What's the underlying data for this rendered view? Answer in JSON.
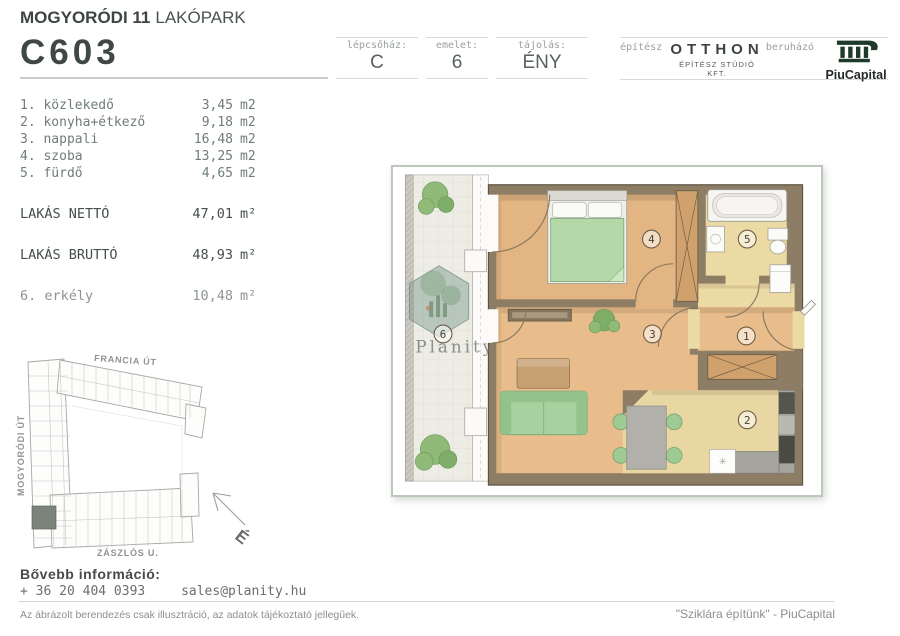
{
  "header": {
    "title_bold": "MOGYORÓDI 11",
    "title_light": "LAKÓPARK",
    "unit_code": "C603",
    "cells": [
      {
        "label": "lépcsőház:",
        "value": "C"
      },
      {
        "label": "emelet:",
        "value": "6"
      },
      {
        "label": "tájolás:",
        "value": "ÉNY"
      }
    ],
    "architect": {
      "label": "építész",
      "name": "OTTHON",
      "subtitle": "ÉPÍTÉSZ STÚDIÓ KFT."
    },
    "developer": {
      "label": "beruházó",
      "name": "PiuCapital"
    }
  },
  "room_list": {
    "rooms": [
      {
        "name": "1. közlekedő",
        "area": "3,45",
        "unit": "m2"
      },
      {
        "name": "2. konyha+étkező",
        "area": "9,18",
        "unit": "m2"
      },
      {
        "name": "3. nappali",
        "area": "16,48",
        "unit": "m2"
      },
      {
        "name": "4. szoba",
        "area": "13,25",
        "unit": "m2"
      },
      {
        "name": "5. fürdő",
        "area": "4,65",
        "unit": "m2"
      }
    ],
    "totals": [
      {
        "name": "LAKÁS NETTÓ",
        "area": "47,01",
        "unit": "m²"
      },
      {
        "name": "LAKÁS BRUTTÓ",
        "area": "48,93",
        "unit": "m²"
      }
    ],
    "balcony": {
      "name": "6. erkély",
      "area": "10,48",
      "unit": "m²"
    }
  },
  "site_plan": {
    "street_top": "FRANCIA ÚT",
    "street_left": "MOGYORÓDI ÚT",
    "street_bottom": "ZÁSZLÓS U.",
    "north": "É"
  },
  "floor_plan": {
    "watermark": "Planity",
    "numbers": {
      "hall": "1",
      "kitchen": "2",
      "living": "3",
      "bedroom": "4",
      "bath": "5",
      "balcony": "6"
    }
  },
  "footer": {
    "info_title": "Bővebb információ:",
    "phone": "+ 36 20 404 0393",
    "email": "sales@planity.hu",
    "disclaimer": "Az ábrázolt berendezés csak illusztráció, az adatok tájékoztató jellegűek.",
    "slogan": "\"Sziklára építünk\" - PiuCapital"
  },
  "colors": {
    "brand_green": "#1d3a2a",
    "wall": "#8d7d64",
    "floor_warm": "#e9bd8b",
    "floor_light": "#ecdaa4",
    "furniture_green": "#a7d19e",
    "highlight_unit": "#7a847b"
  }
}
